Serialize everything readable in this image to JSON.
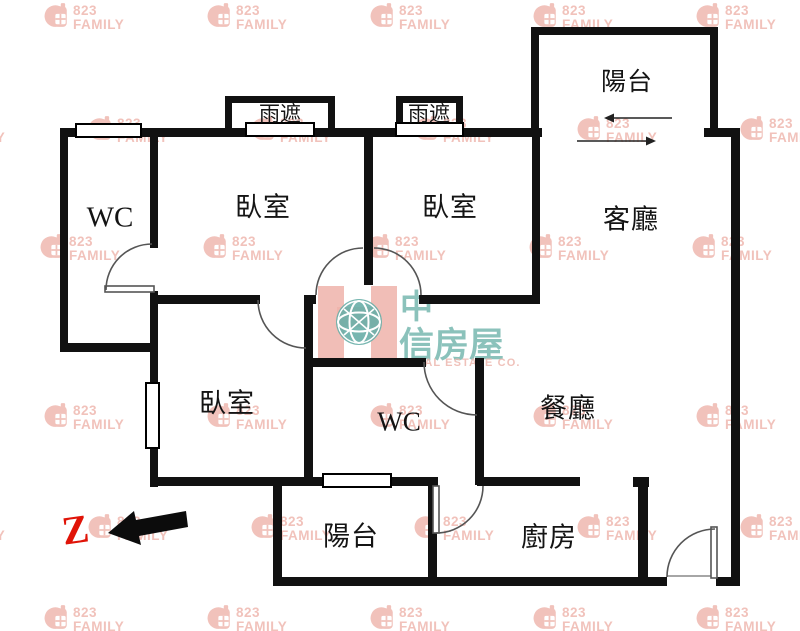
{
  "page": {
    "type": "apartment floor plan"
  },
  "rooms": [
    {
      "id": "wc-top-left",
      "label": "WC"
    },
    {
      "id": "bedroom-top-left",
      "label": "臥室"
    },
    {
      "id": "bedroom-top-right",
      "label": "臥室"
    },
    {
      "id": "living-room",
      "label": "客廳"
    },
    {
      "id": "balcony-top",
      "label": "陽台"
    },
    {
      "id": "bedroom-lower",
      "label": "臥室"
    },
    {
      "id": "bathroom-center",
      "label": "WC"
    },
    {
      "id": "dining-room",
      "label": "餐廳"
    },
    {
      "id": "balcony-bottom",
      "label": "陽台"
    },
    {
      "id": "kitchen",
      "label": "廚房"
    }
  ],
  "rain_shelters": [
    "雨遮",
    "雨遮"
  ],
  "north_marker": {
    "letter": "Z"
  },
  "watermark": {
    "number": "823",
    "name": "FAMILY",
    "color": "#f1c2bb",
    "rows": [
      {
        "y": 2,
        "x": [
          44,
          207,
          370,
          533,
          696
        ]
      },
      {
        "y": 115,
        "x": [
          -75,
          88,
          251,
          414,
          577,
          740
        ]
      },
      {
        "y": 233,
        "x": [
          40,
          203,
          366,
          529,
          692
        ]
      },
      {
        "y": 402,
        "x": [
          44,
          207,
          370,
          533,
          696
        ]
      },
      {
        "y": 513,
        "x": [
          -75,
          88,
          251,
          414,
          577,
          740
        ]
      },
      {
        "y": 604,
        "x": [
          44,
          207,
          370,
          533,
          696
        ]
      }
    ]
  },
  "logo": {
    "accent_char": "中",
    "brand": "信房屋",
    "caption": "CHINATRUST REAL ESTATE CO.",
    "teal": "#7fbcb4",
    "pink": "#efb3aa"
  },
  "colors": {
    "walls": "#111111",
    "door_arc": "#555555",
    "north_red": "#e01408"
  }
}
